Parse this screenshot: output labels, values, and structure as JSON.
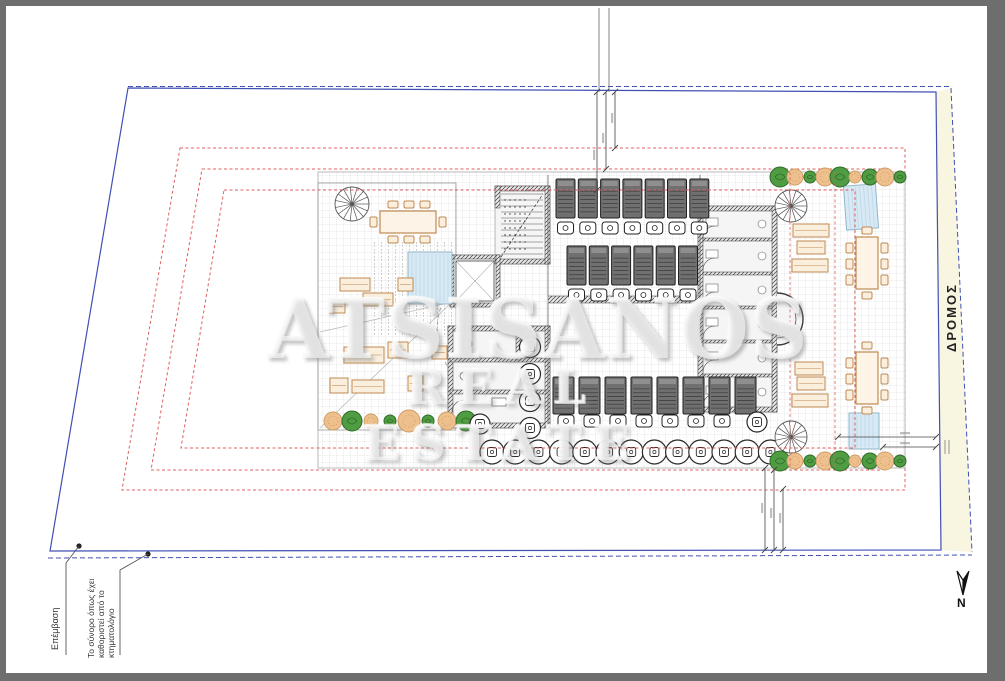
{
  "document": {
    "type": "architectural-site-plan"
  },
  "watermark": {
    "line1": "ATSISANOS",
    "line2": "REAL ESTATE"
  },
  "labels": {
    "road": "ΔΡΟΜΟΣ",
    "north": "N",
    "annotation_intervention": "Επέμβαση",
    "annotation_boundary": "Το σύνορο όπως έχει καθοριστεί από το κτηματολόγιο"
  },
  "colors": {
    "frame_gray": "#6e6e6e",
    "boundary_blue": "#4050b5",
    "setback_red": "#e06060",
    "road_fill": "#f8f5e1",
    "grid_line": "#d8d8d8",
    "wall": "#3c3c3c",
    "sunbed": "#707070",
    "tree_green": "#4f9c42",
    "tree_orange": "#eec08e",
    "furniture_tan": "#c08a52",
    "furniture_fill": "#faeedd",
    "pool_fill": "#d6e9f4",
    "pool_stroke": "#93b6ca"
  },
  "plan": {
    "sunbed_rows": {
      "top_row_1": 7,
      "top_row_2": 6,
      "bottom_row": 8
    },
    "side_tables_bottom": 7,
    "round_tables_bottom": 13,
    "round_tables_stacked": 4,
    "trees": {
      "left_row": 8,
      "right_top_row": 9,
      "right_bottom_row": 9
    },
    "dining_tables": 3,
    "spiral_stairs": 3,
    "pools": 3
  }
}
